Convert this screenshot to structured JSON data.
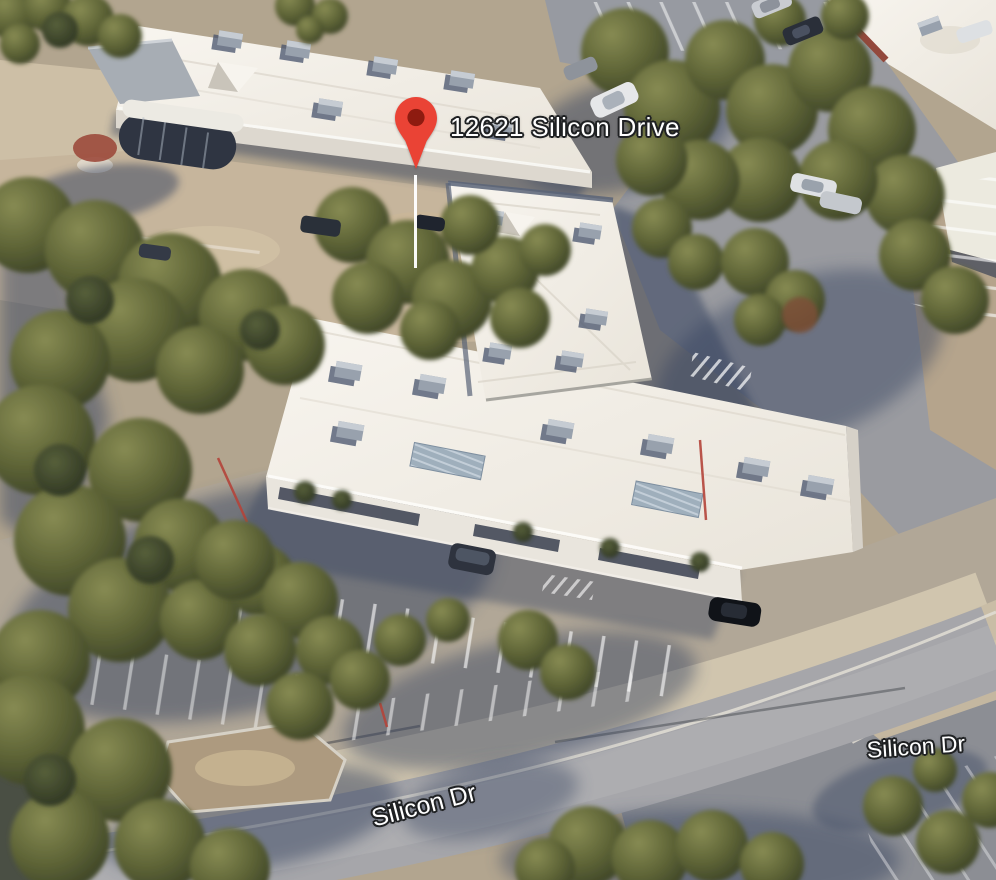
{
  "map": {
    "view_type": "3d-aerial",
    "pin_label": "12621 Silicon Drive",
    "road_labels": [
      {
        "text": "Silicon Dr"
      },
      {
        "text": "Silicon Dr"
      }
    ],
    "pin": {
      "icon": "map-pin-icon"
    }
  },
  "palette": {
    "pin-red": "#EA4335",
    "pin-dot": "#8E1B10",
    "label-text": "#ffffff",
    "label-outline": "#1f2123",
    "roof-white": "#f3efe8",
    "roof-shade": "#e3ded3",
    "tree-olive": "#5d6336",
    "shadow-blue": "#36425e",
    "road-grey": "#a6a6aa",
    "pavement-tan": "#c3b29a",
    "parking-grey": "#9a9ba0"
  }
}
